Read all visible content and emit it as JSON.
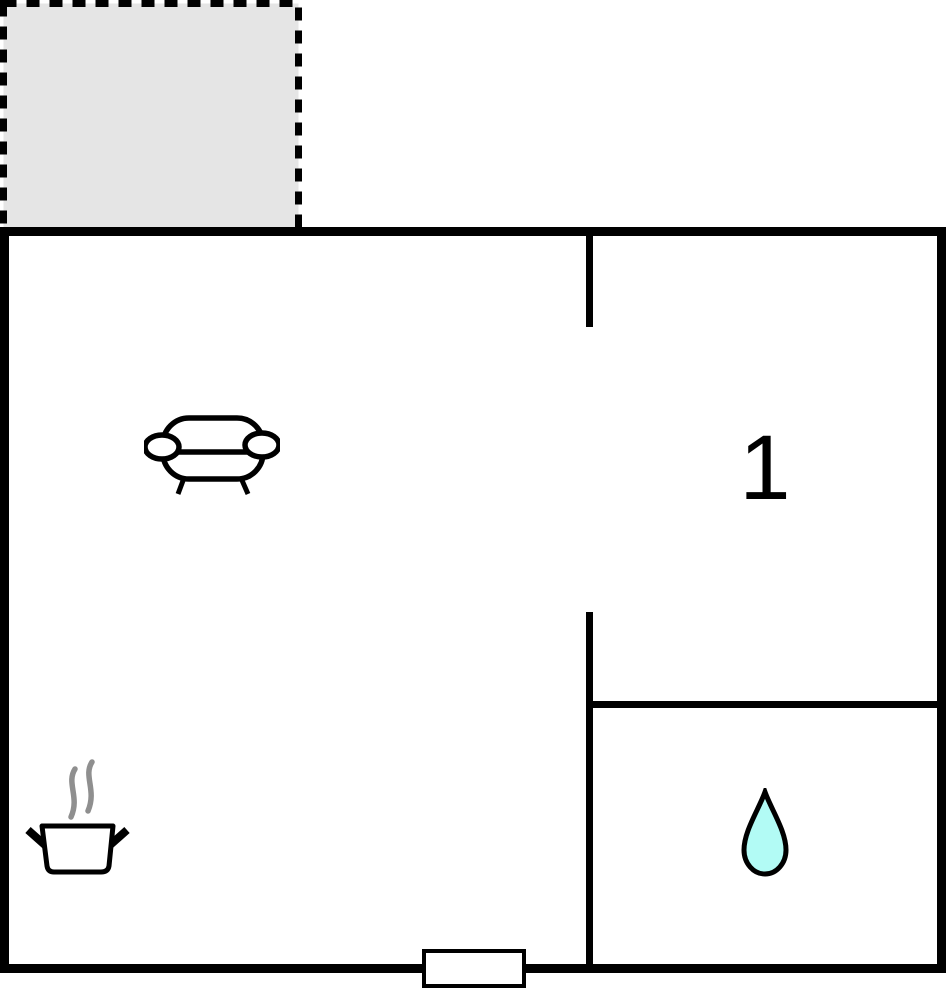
{
  "page": {
    "title": "Floor plan"
  },
  "colors": {
    "wall": "#000000",
    "canvas_bg": "#ffffff",
    "room_fill": "#ffffff",
    "terrace_fill": "#e5e5e5",
    "drop_fill": "#b2fbf5",
    "steam_gray": "#8f8f8f"
  },
  "rooms": {
    "bedroom": {
      "label": "1"
    }
  },
  "icons": {
    "living_area": "sofa-icon",
    "kitchen": "cooking-pot-icon",
    "bathroom": "water-drop-icon"
  },
  "features": {
    "terrace": "dashed-outline-area",
    "entrance": "door-on-bottom-wall"
  }
}
